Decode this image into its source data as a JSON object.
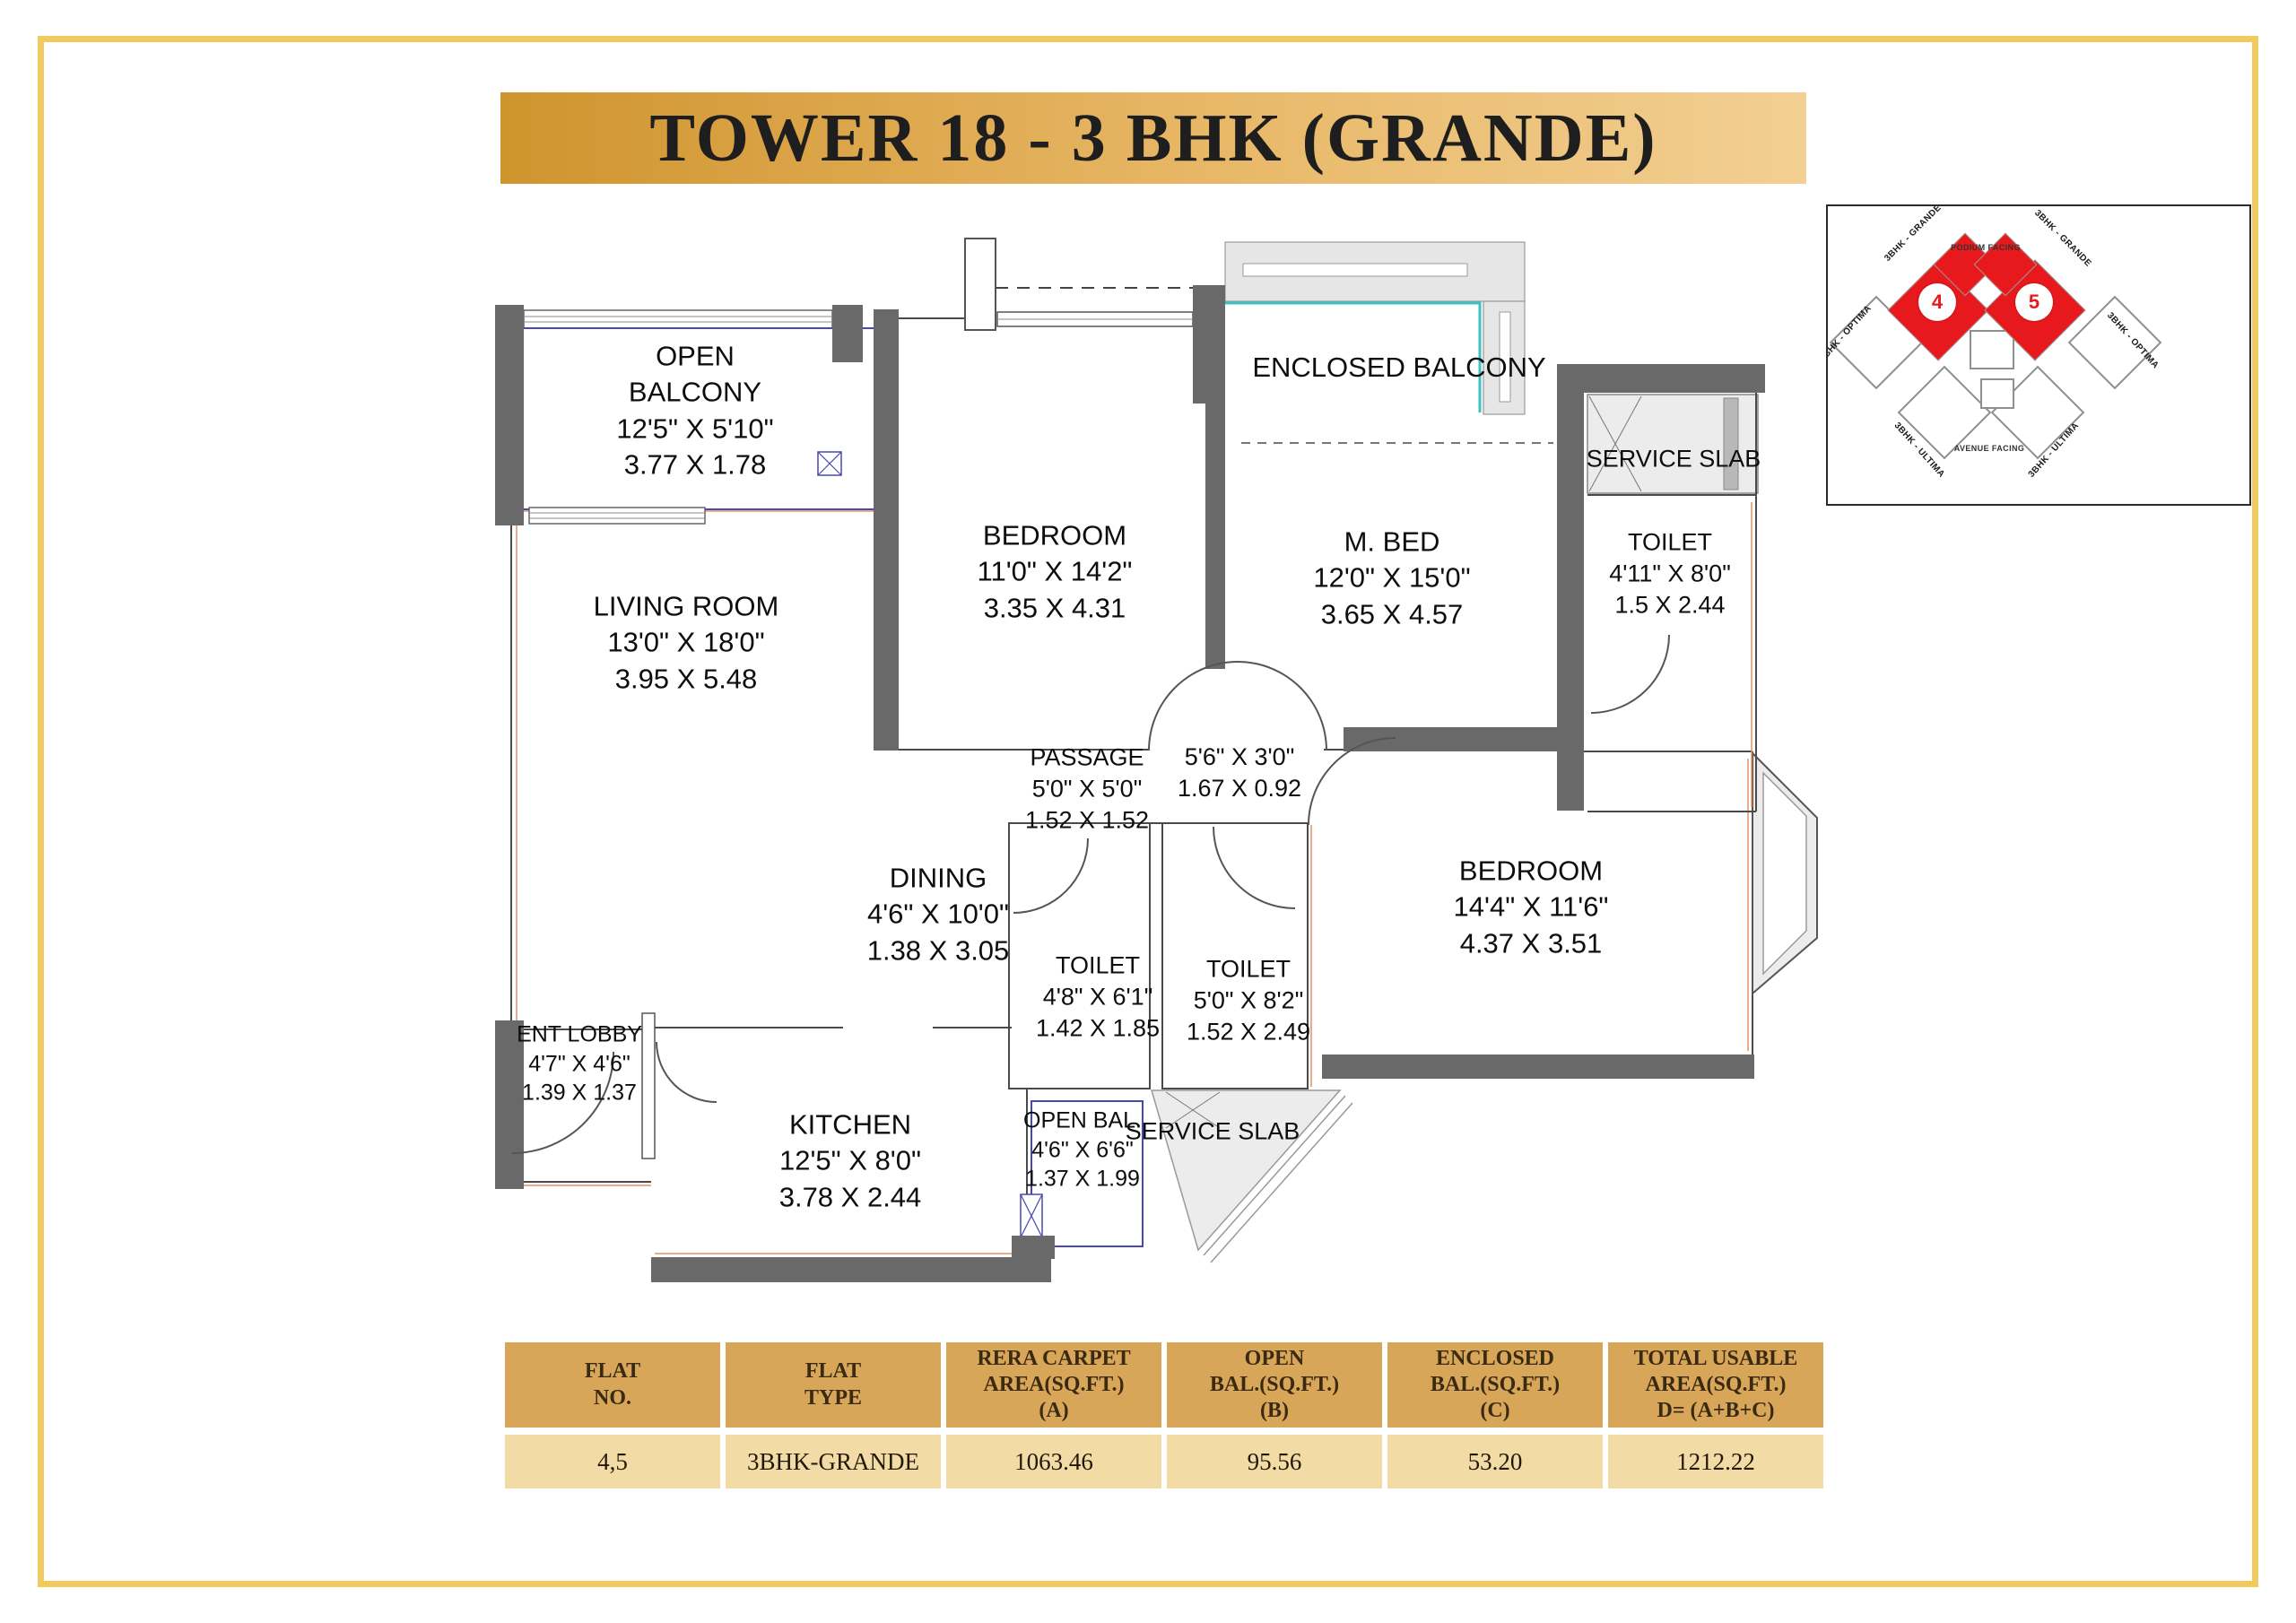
{
  "title": "TOWER 18 - 3 BHK (GRANDE)",
  "colors": {
    "banner_gold": "#d0942e",
    "wall_gray": "#696969",
    "balcony_blue": "#4848b0",
    "glazing_teal": "#3fc0c0",
    "accent_orange": "#e09060",
    "highlight_red": "#e8191d",
    "table_header_tan": "#d8a659",
    "table_row_tan": "#f3dba6",
    "frame_gold": "#f0ca5e"
  },
  "rooms": {
    "open_balcony": {
      "name": "OPEN BALCONY",
      "imperial": "12'5\" X 5'10\"",
      "metric": "3.77 X 1.78"
    },
    "living_room": {
      "name": "LIVING ROOM",
      "imperial": "13'0\" X 18'0\"",
      "metric": "3.95 X 5.48"
    },
    "bedroom_top": {
      "name": "BEDROOM",
      "imperial": "11'0\" X 14'2\"",
      "metric": "3.35 X 4.31"
    },
    "enclosed_balcony": {
      "name": "ENCLOSED BALCONY"
    },
    "master_bed": {
      "name": "M. BED",
      "imperial": "12'0\" X 15'0\"",
      "metric": "3.65 X 4.57"
    },
    "service_slab_top": {
      "name": "SERVICE SLAB"
    },
    "toilet_top": {
      "name": "TOILET",
      "imperial": "4'11\" X 8'0\"",
      "metric": "1.5 X 2.44"
    },
    "passage": {
      "name": "PASSAGE",
      "imperial": "5'0\" X 5'0\"",
      "metric": "1.52 X 1.52"
    },
    "passage_niche": {
      "name": "",
      "imperial": "5'6\" X 3'0\"",
      "metric": "1.67 X 0.92"
    },
    "dining": {
      "name": "DINING",
      "imperial": "4'6\" X 10'0\"",
      "metric": "1.38 X 3.05"
    },
    "toilet_mid": {
      "name": "TOILET",
      "imperial": "4'8\" X 6'1\"",
      "metric": "1.42 X 1.85"
    },
    "toilet_mid2": {
      "name": "TOILET",
      "imperial": "5'0\" X 8'2\"",
      "metric": "1.52 X 2.49"
    },
    "bedroom_right": {
      "name": "BEDROOM",
      "imperial": "14'4\" X 11'6\"",
      "metric": "4.37 X 3.51"
    },
    "ent_lobby": {
      "name": "ENT LOBBY",
      "imperial": "4'7\" X 4'6\"",
      "metric": "1.39 X 1.37"
    },
    "kitchen": {
      "name": "KITCHEN",
      "imperial": "12'5\" X 8'0\"",
      "metric": "3.78 X 2.44"
    },
    "open_bal_bottom": {
      "name": "OPEN BAL.",
      "imperial": "4'6\" X 6'6\"",
      "metric": "1.37 X 1.99"
    },
    "service_slab_bottom": {
      "name": "SERVICE SLAB"
    }
  },
  "keyplan": {
    "units": [
      "4",
      "5"
    ],
    "labels": {
      "grande_left": "3BHK - GRANDE",
      "grande_right": "3BHK - GRANDE",
      "podium": "PODIUM FACING",
      "optima_left": "3BHK - OPTIMA",
      "optima_right": "3BHK - OPTIMA",
      "ultima_bl": "3BHK - ULTIMA",
      "ultima_br": "3BHK - ULTIMA",
      "avenue": "AVENUE FACING"
    }
  },
  "table": {
    "columns": [
      {
        "l1": "FLAT",
        "l2": "NO.",
        "l3": ""
      },
      {
        "l1": "FLAT",
        "l2": "TYPE",
        "l3": ""
      },
      {
        "l1": "RERA CARPET",
        "l2": "AREA(SQ.FT.)",
        "l3": "(A)"
      },
      {
        "l1": "OPEN",
        "l2": "BAL.(SQ.FT.)",
        "l3": "(B)"
      },
      {
        "l1": "ENCLOSED",
        "l2": "BAL.(SQ.FT.)",
        "l3": "(C)"
      },
      {
        "l1": "TOTAL USABLE",
        "l2": "AREA(SQ.FT.)",
        "l3": "D= (A+B+C)"
      }
    ],
    "row": [
      "4,5",
      "3BHK-GRANDE",
      "1063.46",
      "95.56",
      "53.20",
      "1212.22"
    ]
  }
}
